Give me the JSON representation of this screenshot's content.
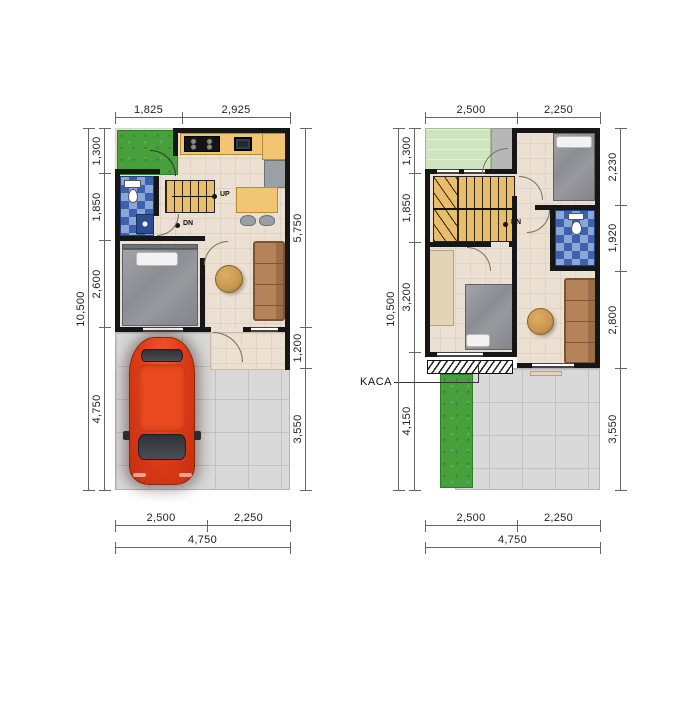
{
  "ground_floor": {
    "dims": {
      "top": [
        "1,825",
        "2,925"
      ],
      "left": [
        "1,300",
        "1,850",
        "2,600",
        "4,750"
      ],
      "left_overall": "10,500",
      "right": [
        "5,750",
        "1,200",
        "3,550"
      ],
      "bottom": [
        "2,500",
        "2,250"
      ],
      "bottom_overall": "4,750"
    },
    "labels": {
      "stairs_up": "UP",
      "stairs_down": "DN"
    }
  },
  "upper_floor": {
    "dims": {
      "top": [
        "2,500",
        "2,250"
      ],
      "left": [
        "1,300",
        "1,850",
        "3,200",
        "4,150"
      ],
      "left_overall": "10,500",
      "right": [
        "2,230",
        "1,920",
        "2,800",
        "3,550"
      ],
      "bottom": [
        "2,500",
        "2,250"
      ],
      "bottom_overall": "4,750"
    },
    "labels": {
      "stairs_down": "DN",
      "glass": "KACA"
    }
  },
  "colors": {
    "wall": "#161616",
    "floor": "#ebe0d2",
    "paving": "#d9d9d9",
    "garden": "#47a03b",
    "roof-garden": "#cfe5c0",
    "stairs": "#e9bd6a",
    "counter": "#f2c573",
    "tile-a": "#3d61ad",
    "tile-b": "#8aa5d8",
    "sofa": "#b5835a",
    "sofa-line": "#7d5433",
    "table-wood": "#c9974f",
    "bed": "#8e9094",
    "car": "#e03c18",
    "dim-line": "#666666",
    "dim-text": "#222222"
  }
}
